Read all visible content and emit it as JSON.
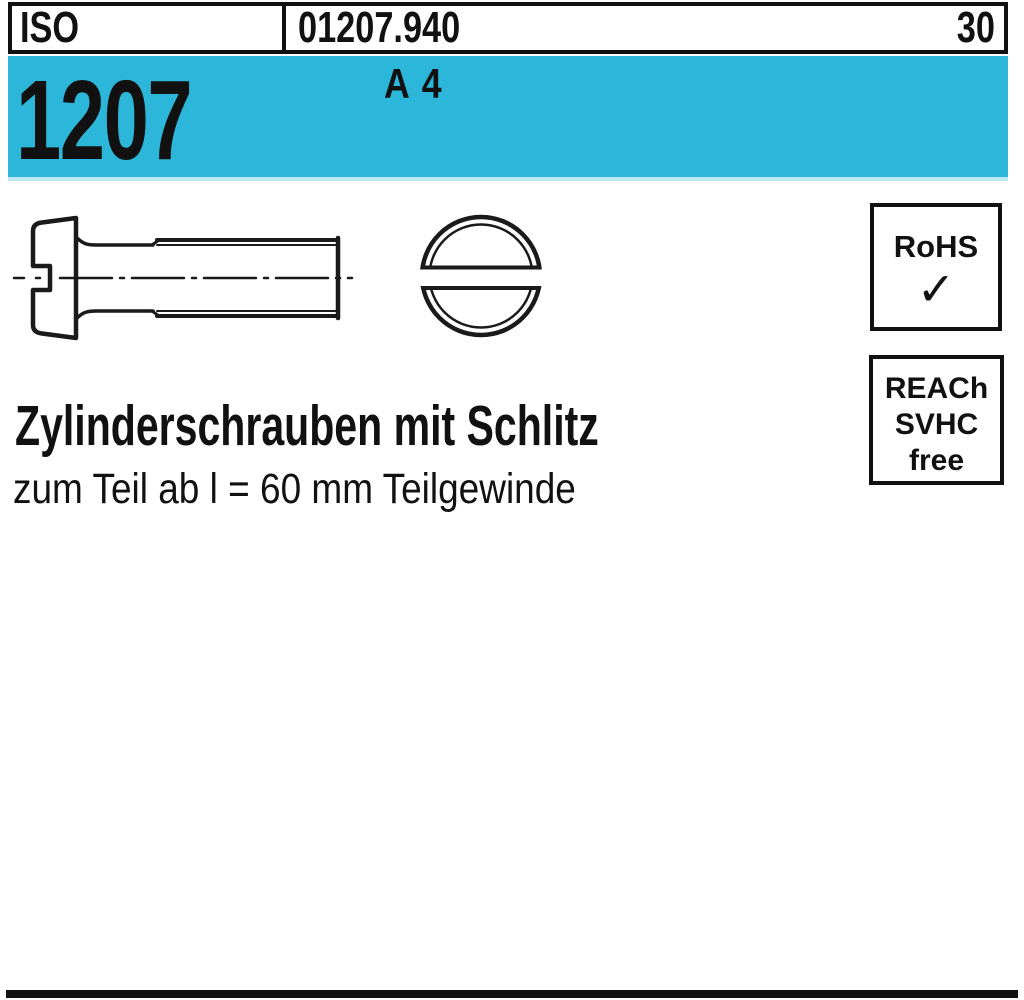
{
  "header": {
    "standard_label": "ISO",
    "article_number": "01207.940",
    "page_number": "30"
  },
  "banner": {
    "standard_number": "1207",
    "material_grade": "A 4",
    "background_color": "#2cb6da"
  },
  "compliance": {
    "rohs": {
      "label": "RoHS",
      "checkmark": "✓"
    },
    "reach": {
      "line1": "REACh",
      "line2": "SVHC",
      "line3": "free"
    }
  },
  "description": {
    "title": "Zylinderschrauben mit Schlitz",
    "subtitle": "zum Teil ab l = 60 mm Teilgewinde"
  },
  "drawing": {
    "subject": "slotted cheese head screw",
    "views": "side view and front view with slot"
  },
  "colors": {
    "ink": "#111111",
    "banner": "#2cb6da",
    "banner_edge": "#bce7f3"
  }
}
